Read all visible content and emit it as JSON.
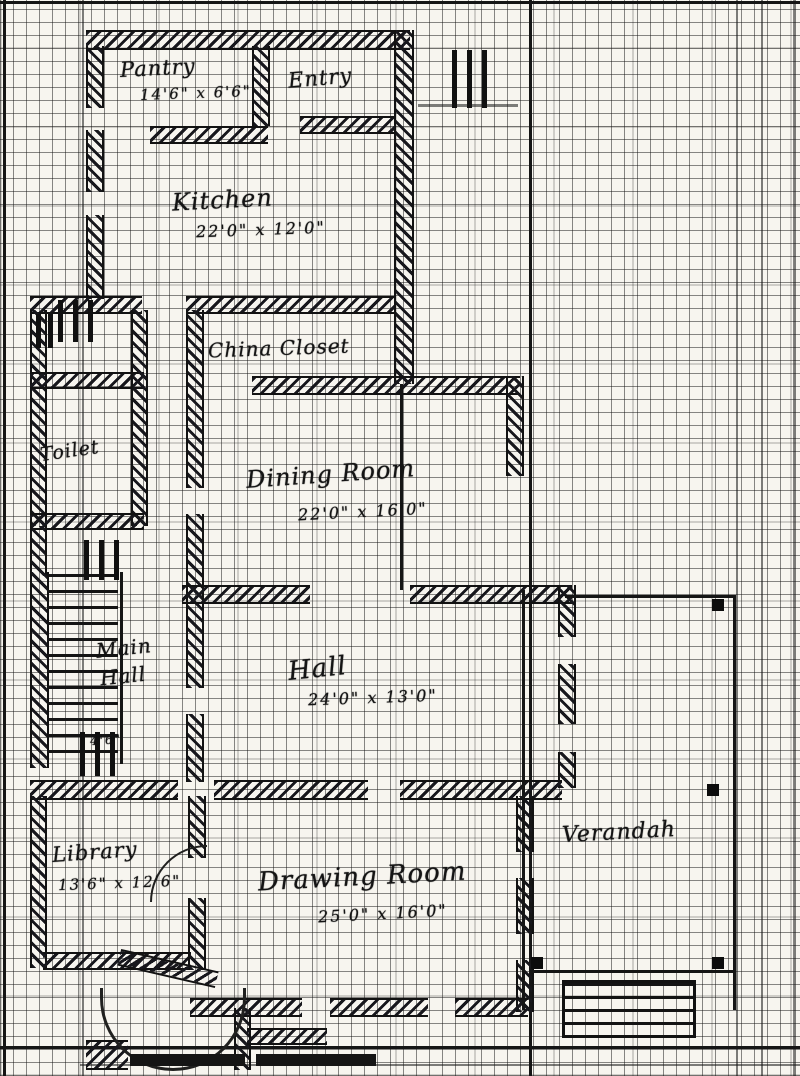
{
  "plan": {
    "rooms": {
      "pantry": {
        "name": "Pantry",
        "dims": "14'6\" x 6'6\""
      },
      "entry": {
        "name": "Entry"
      },
      "kitchen": {
        "name": "Kitchen",
        "dims": "22'0\" x 12'0\""
      },
      "china_closet": {
        "name": "China Closet"
      },
      "toilet": {
        "name": "Toilet"
      },
      "dining_room": {
        "name": "Dining Room",
        "dims": "22'0\" x 16'0\""
      },
      "main_hall": {
        "line1": "Main",
        "line2": "Hall"
      },
      "hall": {
        "name": "Hall",
        "dims": "24'0\" x 13'0\""
      },
      "library": {
        "name": "Library",
        "dims": "13'6\" x 12'6\""
      },
      "drawing_room": {
        "name": "Drawing Room",
        "dims": "25'0\" x 16'0\""
      },
      "verandah": {
        "name": "Verandah"
      }
    },
    "annotations": {
      "stair_width": "4'6\""
    },
    "colors": {
      "ink": "#151515",
      "paper": "#f7f5ef"
    }
  }
}
